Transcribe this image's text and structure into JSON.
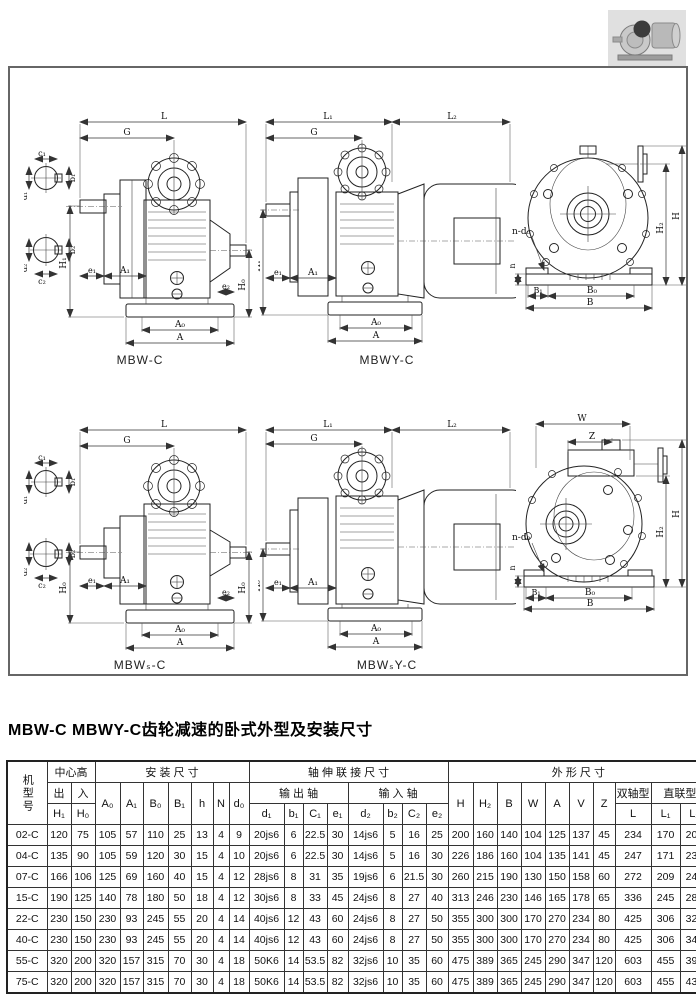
{
  "page": {
    "title": "MBW-C MBWY-C齿轮减速的卧式外型及安装尺寸"
  },
  "captions": {
    "mbw_c": "MBW-C",
    "mbwy_c": "MBWY-C",
    "mbws_c": "MBWₛ-C",
    "mbwsy_c": "MBWₛY-C"
  },
  "dims": {
    "L": "L",
    "L1": "L₁",
    "L2": "L₂",
    "G": "G",
    "H": "H",
    "H0": "H₀",
    "H1": "H₁",
    "H2": "H₂",
    "A": "A",
    "A0": "A₀",
    "A1": "A₁",
    "B": "B",
    "B0": "B₀",
    "B1": "B₁",
    "e1": "e₁",
    "e2": "e₂",
    "h": "h",
    "W": "W",
    "Z": "Z",
    "ndo": "n-d₀",
    "c1": "c₁",
    "b1": "b₁",
    "d1": "d₁",
    "c2": "c₂",
    "b2": "b₂",
    "d2": "d₂"
  },
  "table": {
    "header": {
      "model": "机型号",
      "center_height": "中心高",
      "out": "出",
      "in": "入",
      "h1": "H₁",
      "h0": "H₀",
      "install": "安 装 尺 寸",
      "install_cols": [
        "A₀",
        "A₁",
        "B₀",
        "B₁",
        "h",
        "N",
        "d₀"
      ],
      "shaft": "轴 伸 联 接 尺 寸",
      "output_shaft": "输 出 轴",
      "output_cols": [
        "d₁",
        "b₁",
        "C₁",
        "e₁"
      ],
      "input_shaft": "输 入 轴",
      "input_cols": [
        "d₂",
        "b₂",
        "C₂",
        "e₂"
      ],
      "outline": "外 形 尺 寸",
      "outline_cols": [
        "H",
        "H₂",
        "B",
        "W",
        "A",
        "V",
        "Z"
      ],
      "double_shaft": "双轴型",
      "double_col": "L",
      "direct": "直联型",
      "direct_cols": [
        "L₁",
        "L₂"
      ]
    },
    "rows": [
      [
        "02-C",
        "120",
        "75",
        "105",
        "57",
        "110",
        "25",
        "13",
        "4",
        "9",
        "20js6",
        "6",
        "22.5",
        "30",
        "14js6",
        "5",
        "16",
        "25",
        "200",
        "160",
        "140",
        "104",
        "125",
        "137",
        "45",
        "234",
        "170",
        "200"
      ],
      [
        "04-C",
        "135",
        "90",
        "105",
        "59",
        "120",
        "30",
        "15",
        "4",
        "10",
        "20js6",
        "6",
        "22.5",
        "30",
        "14js6",
        "5",
        "16",
        "30",
        "226",
        "186",
        "160",
        "104",
        "135",
        "141",
        "45",
        "247",
        "171",
        "235"
      ],
      [
        "07-C",
        "166",
        "106",
        "125",
        "69",
        "160",
        "40",
        "15",
        "4",
        "12",
        "28js6",
        "8",
        "31",
        "35",
        "19js6",
        "6",
        "21.5",
        "30",
        "260",
        "215",
        "190",
        "130",
        "150",
        "158",
        "60",
        "272",
        "209",
        "245"
      ],
      [
        "15-C",
        "190",
        "125",
        "140",
        "78",
        "180",
        "50",
        "18",
        "4",
        "12",
        "30js6",
        "8",
        "33",
        "45",
        "24js6",
        "8",
        "27",
        "40",
        "313",
        "246",
        "230",
        "146",
        "165",
        "178",
        "65",
        "336",
        "245",
        "285"
      ],
      [
        "22-C",
        "230",
        "150",
        "230",
        "93",
        "245",
        "55",
        "20",
        "4",
        "14",
        "40js6",
        "12",
        "43",
        "60",
        "24js6",
        "8",
        "27",
        "50",
        "355",
        "300",
        "300",
        "170",
        "270",
        "234",
        "80",
        "425",
        "306",
        "320"
      ],
      [
        "40-C",
        "230",
        "150",
        "230",
        "93",
        "245",
        "55",
        "20",
        "4",
        "14",
        "40js6",
        "12",
        "43",
        "60",
        "24js6",
        "8",
        "27",
        "50",
        "355",
        "300",
        "300",
        "170",
        "270",
        "234",
        "80",
        "425",
        "306",
        "340"
      ],
      [
        "55-C",
        "320",
        "200",
        "320",
        "157",
        "315",
        "70",
        "30",
        "4",
        "18",
        "50K6",
        "14",
        "53.5",
        "82",
        "32js6",
        "10",
        "35",
        "60",
        "475",
        "389",
        "365",
        "245",
        "290",
        "347",
        "120",
        "603",
        "455",
        "395"
      ],
      [
        "75-C",
        "320",
        "200",
        "320",
        "157",
        "315",
        "70",
        "30",
        "4",
        "18",
        "50K6",
        "14",
        "53.5",
        "82",
        "32js6",
        "10",
        "35",
        "60",
        "475",
        "389",
        "365",
        "245",
        "290",
        "347",
        "120",
        "603",
        "455",
        "435"
      ]
    ]
  }
}
